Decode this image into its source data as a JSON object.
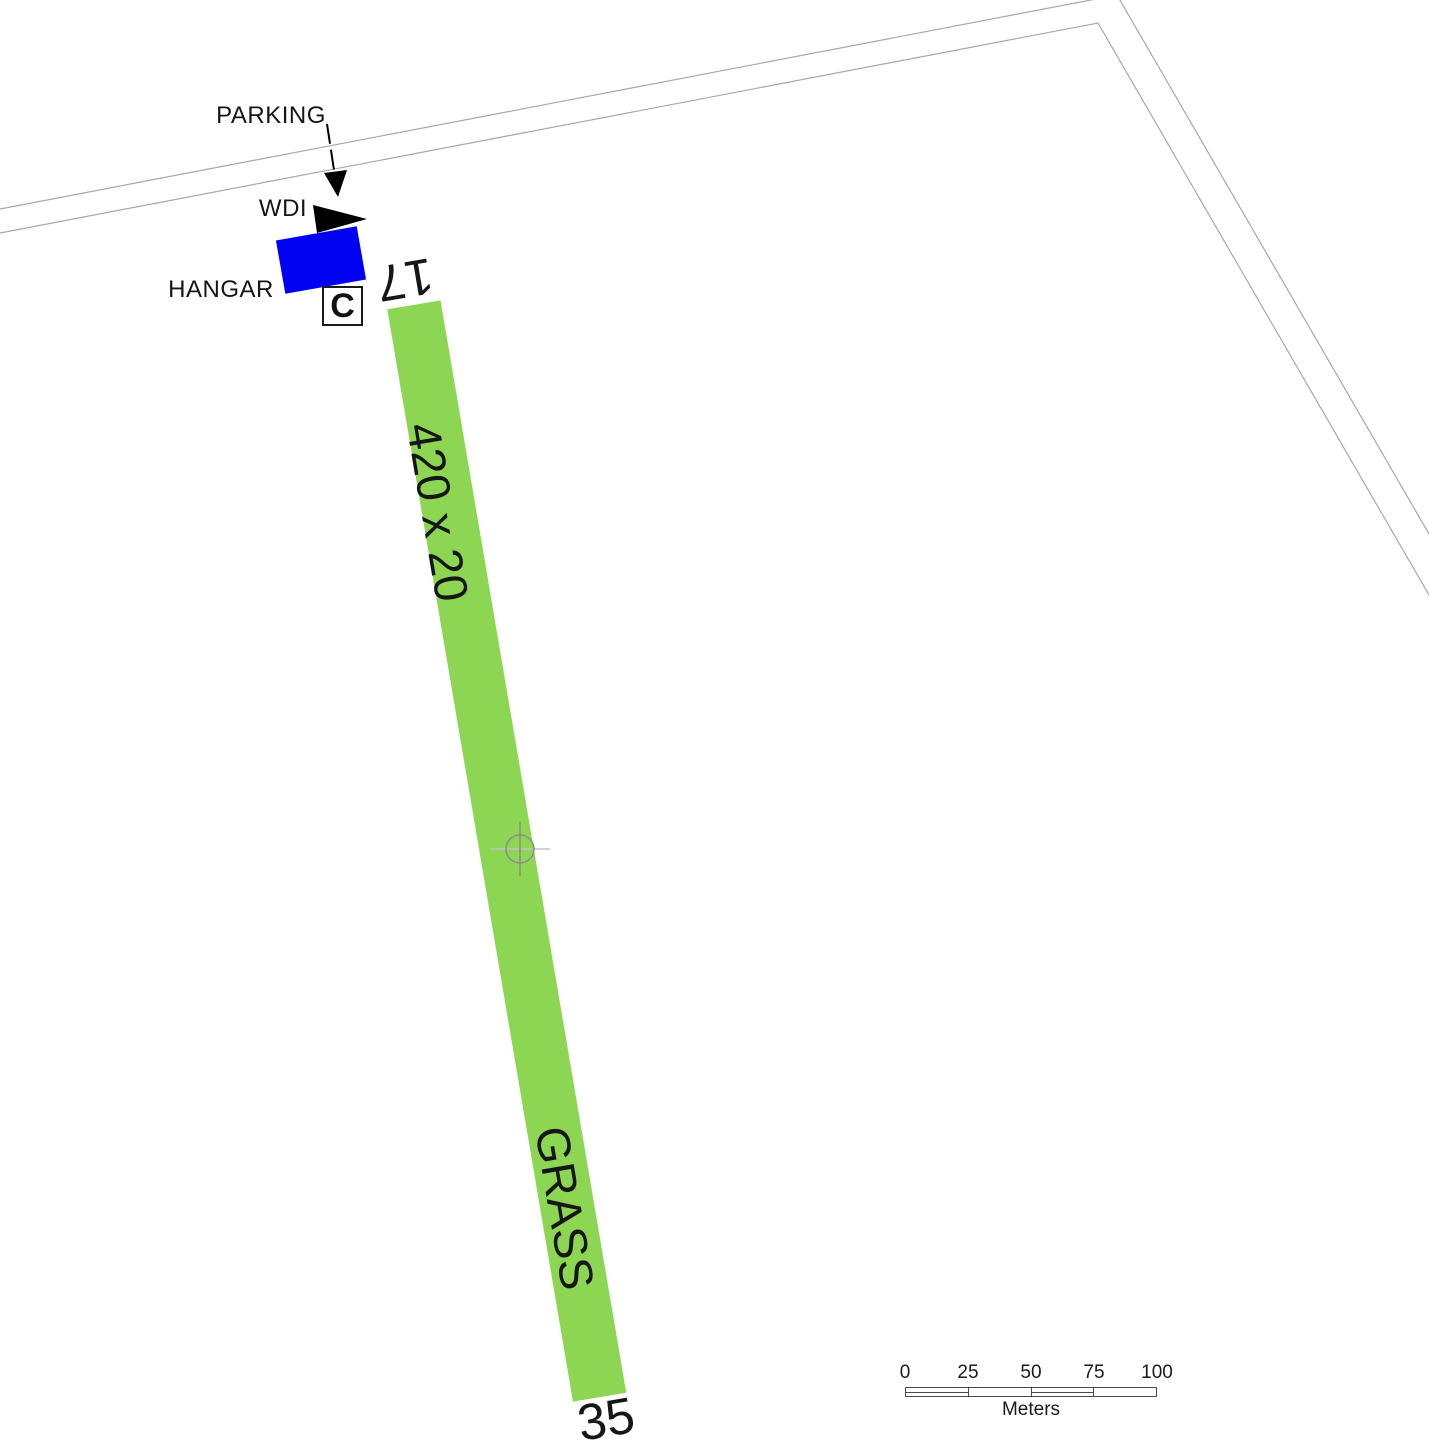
{
  "labels": {
    "parking": "PARKING",
    "wdi": "WDI",
    "hangar": "HANGAR",
    "circuit_marker": "C"
  },
  "runway": {
    "designator_north": "17",
    "designator_south": "35",
    "dimensions": "420 x 20",
    "surface": "GRASS",
    "color": "#8CD653"
  },
  "colors": {
    "hangar": "#0202F2",
    "boundary_line": "#A8A8A8",
    "marker_gray": "#8C8C8C",
    "crosshair_gray": "#C2C2C2"
  },
  "scale_bar": {
    "ticks": [
      "0",
      "25",
      "50",
      "75",
      "100"
    ],
    "unit_label": "Meters"
  }
}
